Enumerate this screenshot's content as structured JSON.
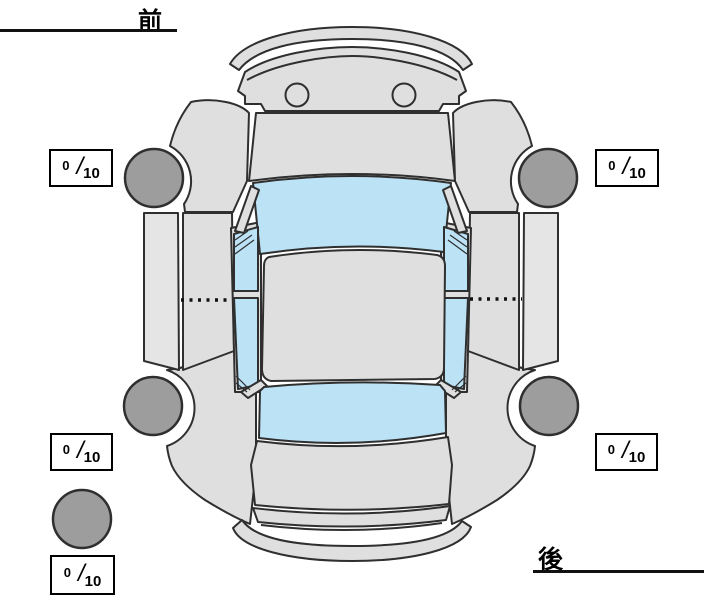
{
  "labels": {
    "front": "前",
    "rear": "後"
  },
  "ratings": {
    "separator": "/",
    "front_left": {
      "value": "0",
      "max": "10"
    },
    "front_right": {
      "value": "0",
      "max": "10"
    },
    "rear_left": {
      "value": "0",
      "max": "10"
    },
    "rear_right": {
      "value": "0",
      "max": "10"
    },
    "spare": {
      "value": "0",
      "max": "10"
    }
  },
  "colors": {
    "background": "#ffffff",
    "body": "#dfdfdf",
    "body-light": "#e5e5e5",
    "glass": "#bce2f5",
    "tire": "#9d9d9d",
    "outline": "#2f2f2f",
    "box-border": "#000000",
    "text": "#000000"
  }
}
